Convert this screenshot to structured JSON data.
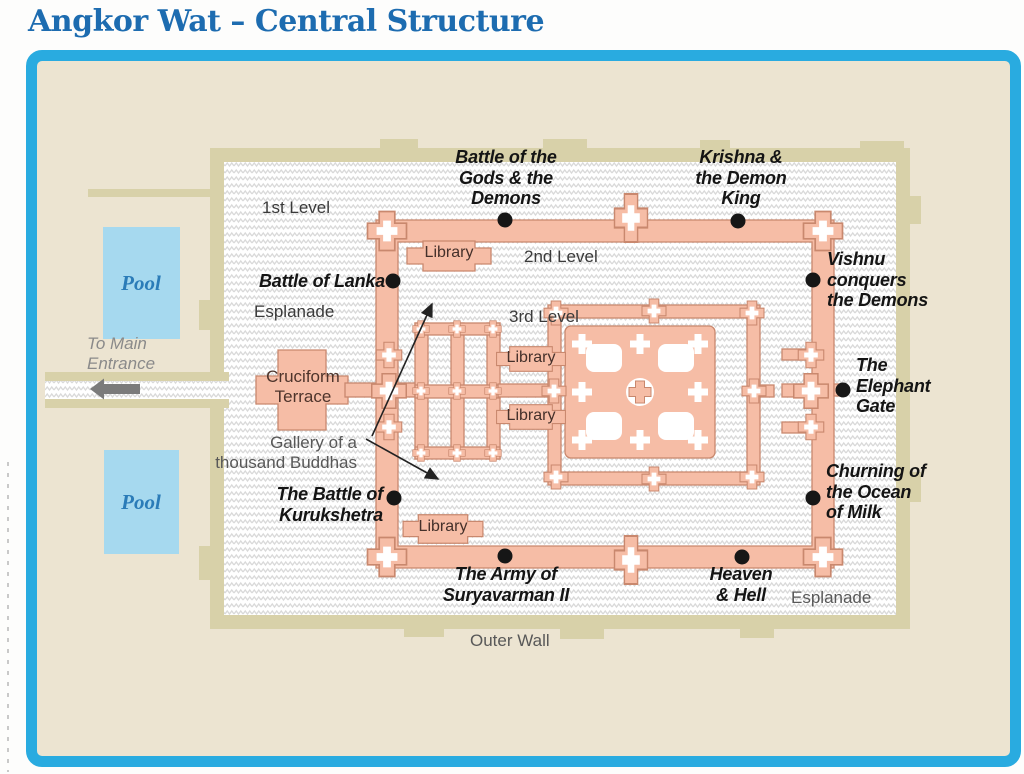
{
  "title": "Angkor Wat – Central Structure",
  "labels": {
    "first_level": "1st Level",
    "second_level": "2nd Level",
    "third_level": "3rd Level",
    "esplanade_west": "Esplanade",
    "esplanade_southeast": "Esplanade",
    "outer_wall": "Outer Wall",
    "cruciform_terrace": "Cruciform\nTerrace",
    "gallery_of_thousand_buddhas": "Gallery of a\nthousand Buddhas",
    "to_main_entrance": "To Main\nEntrance",
    "library_northwest": "Library",
    "library_west_upper": "Library",
    "library_west_lower": "Library",
    "library_southwest": "Library",
    "pool_north": "Pool",
    "pool_south": "Pool"
  },
  "bas_reliefs": {
    "battle_gods_demons": "Battle of the\nGods & the\nDemons",
    "krishna_demon_king": "Krishna &\nthe Demon\nKing",
    "battle_of_lanka": "Battle of Lanka",
    "vishnu_conquers_demons": "Vishnu\nconquers\nthe Demons",
    "elephant_gate": "The\nElephant\nGate",
    "churning_ocean_milk": "Churning of\nthe Ocean\nof Milk",
    "battle_of_kurukshetra": "The Battle of\nKurukshetra",
    "army_of_suryavarman": "The Army of\nSuryavarman II",
    "heaven_and_hell": "Heaven\n& Hell"
  },
  "colors": {
    "title": "#1d6cb0",
    "frame_border": "#29abe0",
    "frame_bg": "#ece4d1",
    "wall_tan": "#d8d1a9",
    "hatch_line": "#d9d9d9",
    "structure": "#f6bda6",
    "structure_outline": "#c9886e",
    "pool_fill": "#a6d9ef",
    "pool_text": "#2b7cb8",
    "dot": "#161616",
    "label_dark": "#3a3a3a",
    "label_gray": "#585858",
    "relief_text": "#141414"
  }
}
